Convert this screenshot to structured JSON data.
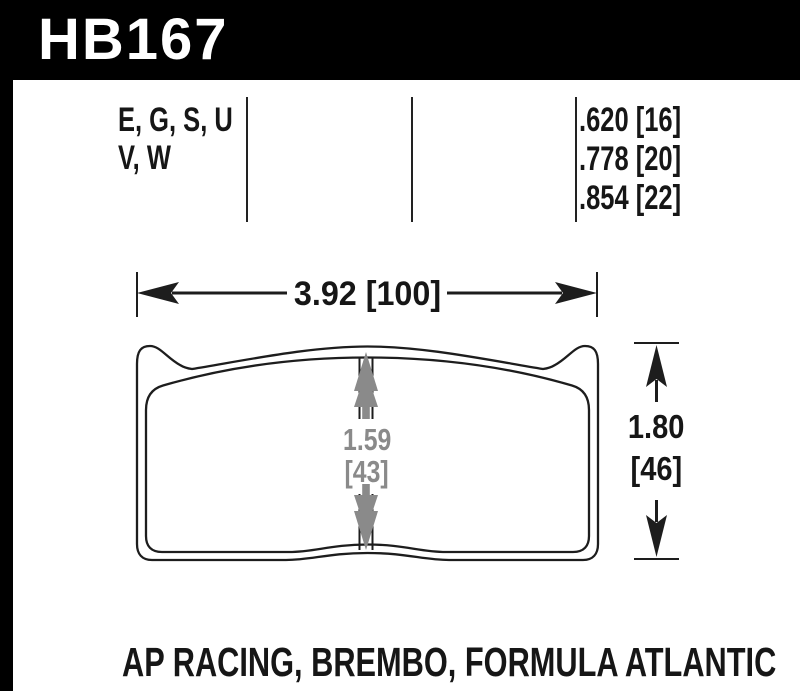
{
  "part_number": "HB167",
  "header": {
    "compounds_line1": "E, G, S, U",
    "compounds_line2": "V, W",
    "thicknesses": [
      ".620 [16]",
      ".778 [20]",
      ".854 [22]"
    ]
  },
  "dimensions": {
    "width": "3.92 [100]",
    "pad_height_value": "1.59",
    "pad_height_mm": "[43]",
    "overall_height_value": "1.80",
    "overall_height_mm": "[46]"
  },
  "caption": "AP RACING, BREMBO, FORMULA ATLANTIC",
  "colors": {
    "banner": "#000000",
    "banner_text": "#ffffff",
    "ink": "#1d1d1d",
    "dim_gray": "#8a8a8a"
  }
}
